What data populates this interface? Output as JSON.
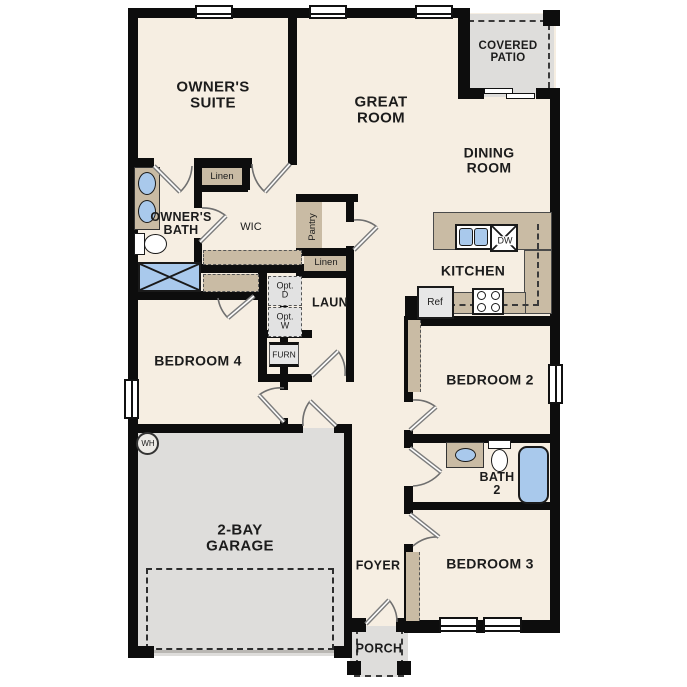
{
  "colors": {
    "floor": "#f6eee2",
    "wall": "#0d0d0d",
    "cabinet_tan": "#c9bba4",
    "concrete_gray": "#dedddb",
    "fixture_blue": "#a9c9ec",
    "appliance_gray": "#e2e2e2"
  },
  "rooms": {
    "owners_suite": "OWNER'S\nSUITE",
    "great_room": "GREAT\nROOM",
    "covered_patio": "COVERED\nPATIO",
    "dining_room": "DINING\nROOM",
    "owners_bath": "OWNER'S\nBATH",
    "wic": "WIC",
    "kitchen": "KITCHEN",
    "laundry": "LAUN",
    "bedroom4": "BEDROOM 4",
    "garage": "2-BAY\nGARAGE",
    "bedroom2": "BEDROOM 2",
    "bath2": "BATH\n2",
    "bedroom3": "BEDROOM 3",
    "foyer": "FOYER",
    "porch": "PORCH"
  },
  "closets": {
    "linen_upper": "Linen",
    "linen_lower": "Linen",
    "pantry": "Pantry"
  },
  "appliances": {
    "refrigerator": "Ref",
    "dishwasher": "DW",
    "furnace": "FURN",
    "water_heater": "WH",
    "optional_dryer": "Opt.\nD",
    "optional_washer": "Opt.\nW"
  }
}
